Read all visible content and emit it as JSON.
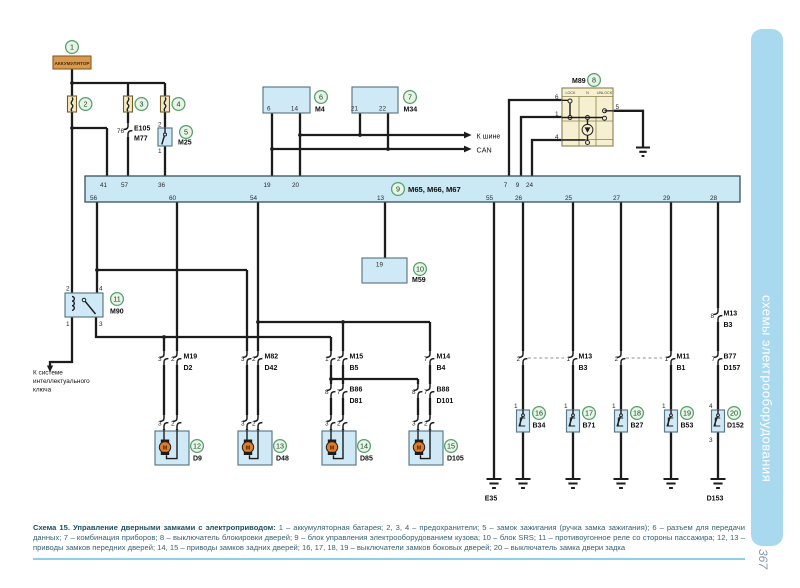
{
  "doc": {
    "sidebar_title": "схемы электрооборудования",
    "page_number": "367",
    "caption_title": "Схема 15. Управление дверными замками с электроприводом:",
    "caption_body": " 1 – аккумуляторная батарея; 2, 3, 4 – предохранители; 5 – замок зажигания (ручка замка зажигания); 6 – разъем для передачи данных; 7 – комбинация приборов; 8 – выключатель блокировки дверей; 9 – блок управления электрооборудованием кузова; 10 – блок SRS; 11 – противоугонное реле со стороны пассажира; 12, 13 – приводы замков передних дверей; 14, 15 – приводы замков задних дверей; 16, 17, 18, 19 – выключатели замков боковых дверей; 20 – выключатель замка двери задка"
  },
  "badges": [
    "1",
    "2",
    "3",
    "4",
    "5",
    "6",
    "7",
    "8",
    "9",
    "10",
    "11",
    "12",
    "13",
    "14",
    "15",
    "16",
    "17",
    "18",
    "19",
    "20"
  ],
  "battery": {
    "label": "АККУМУЛЯТОР"
  },
  "e105": {
    "pin": "76",
    "name1": "E105",
    "name2": "M77"
  },
  "m25": {
    "name": "M25",
    "pin_top": "2",
    "pin_bot": "1"
  },
  "m4": {
    "name": "M4",
    "pin_a": "6",
    "pin_b": "14"
  },
  "m34": {
    "name": "M34",
    "pin_a": "21",
    "pin_b": "22"
  },
  "can": {
    "line1": "К шине",
    "line2": "CAN"
  },
  "m89": {
    "name": "M89",
    "col1": "LOCK",
    "col2": "N",
    "col3": "UNLOCK",
    "pin6": "6",
    "pin1": "1",
    "pin4": "4",
    "pin5": "5"
  },
  "bus": {
    "name": "M65, M66, M67",
    "top": [
      "41",
      "57",
      "36",
      "19",
      "20",
      "7",
      "9",
      "24"
    ],
    "bottom": [
      "56",
      "60",
      "54",
      "13",
      "55",
      "26",
      "25",
      "27",
      "29",
      "28"
    ]
  },
  "m59": {
    "name": "M59",
    "pin": "19"
  },
  "m90": {
    "name": "M90",
    "pin2": "2",
    "pin4": "4",
    "pin1": "1",
    "pin3": "3"
  },
  "smart_key": {
    "line1": "К системе",
    "line2": "интеллектуального",
    "line3": "ключа"
  },
  "conn_row": [
    {
      "pa": "3",
      "pb": "2",
      "name1": "M19",
      "name2": "D2"
    },
    {
      "pa": "3",
      "pb": "2",
      "name1": "M82",
      "name2": "D42"
    },
    {
      "pa": "1",
      "pb": "2",
      "name1": "M15",
      "name2": "B5"
    },
    {
      "pa": "7",
      "name1": "M14",
      "name2": "B4"
    }
  ],
  "conn_row2": [
    {
      "pa": "8",
      "pb": "7",
      "name1": "B86",
      "name2": "D81"
    },
    {
      "pa": "8",
      "pb": "7",
      "name1": "B88",
      "name2": "D101"
    }
  ],
  "act_conn": {
    "pa": "3",
    "pb": "2"
  },
  "actuators": [
    {
      "name": "D9"
    },
    {
      "name": "D48"
    },
    {
      "name": "D85"
    },
    {
      "name": "D105"
    }
  ],
  "motor": {
    "label": "M"
  },
  "right": {
    "top_conn": {
      "pin": "8",
      "name1": "M13",
      "name2": "B3"
    },
    "pair1": {
      "pa": "2",
      "pb": "1",
      "name1": "M13",
      "name2": "B3"
    },
    "pair2": {
      "pa": "2",
      "pb": "1",
      "name1": "M11",
      "name2": "B1"
    },
    "tail_conn": {
      "pin": "7",
      "name1": "B77",
      "name2": "D157"
    },
    "switches": [
      {
        "pin": "1",
        "name": "B34"
      },
      {
        "pin": "1",
        "name": "B71"
      },
      {
        "pin": "1",
        "name": "B27"
      },
      {
        "pin": "1",
        "name": "B53"
      },
      {
        "pin_top": "4",
        "pin_bot": "3",
        "name": "D152"
      }
    ],
    "gnd_left": "E35",
    "gnd_right": "D153"
  }
}
